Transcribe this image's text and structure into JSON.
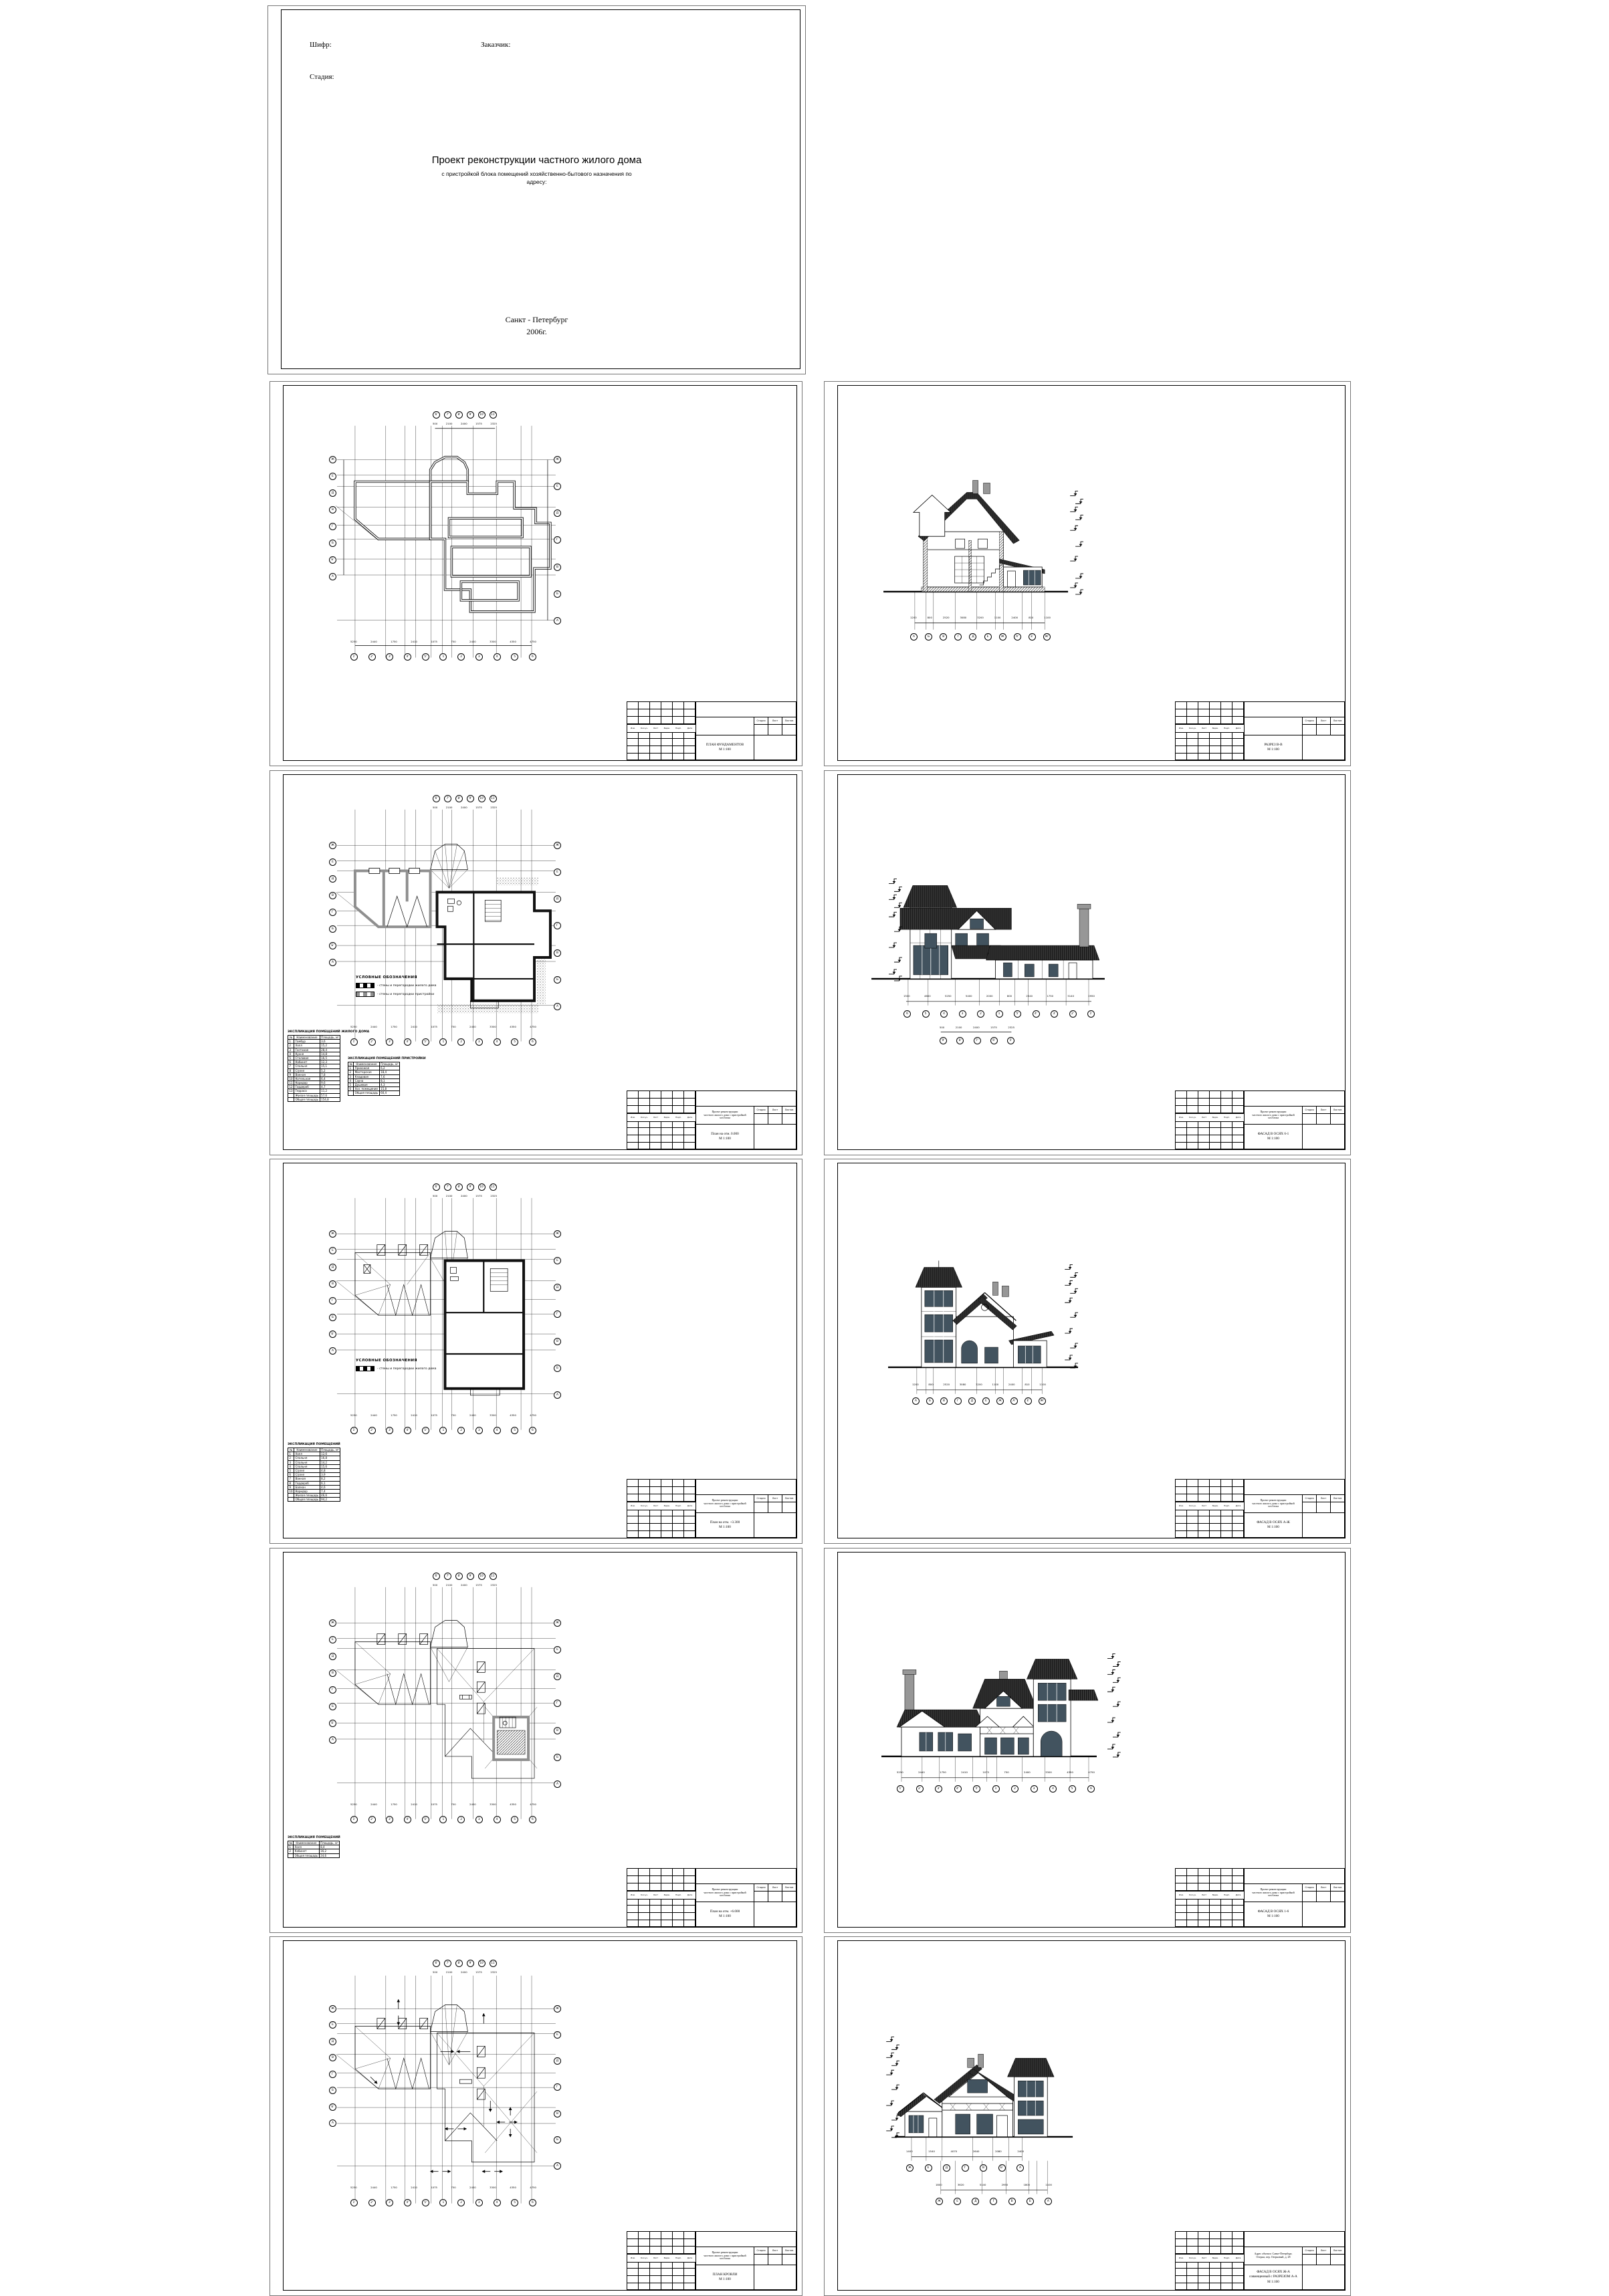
{
  "colors": {
    "ink": "#000000",
    "roof_dark": "#1c1c1c",
    "window_glass": "#42535f",
    "addition_wall_gray": "#8f8f8f",
    "chimney_gray": "#979797",
    "paper": "#ffffff"
  },
  "title_page": {
    "code_label": "Шифр:",
    "client_label": "Заказчик:",
    "stage_label": "Стадия:",
    "title": "Проект реконструкции частного жилого дома",
    "subtitle_line1": "с пристройкой блока помещений хозяйственно-бытового назначения по",
    "subtitle_line2": "адресу:",
    "city": "Санкт - Петербург",
    "year": "2006г."
  },
  "stamp_common": {
    "revision_headers": [
      "Изм.",
      "Кол.уч.",
      "Лист",
      "№док.",
      "Подп.",
      "Дата"
    ],
    "status_headers": [
      "Стадия",
      "Лист",
      "Листов"
    ]
  },
  "tables": {
    "cols": [
      "№",
      "Наименование",
      "Площадь, м²"
    ],
    "home": {
      "title": "ЭКСПЛИКАЦИЯ ПОМЕЩЕНИЙ ЖИЛОГО ДОМА",
      "rows": [
        [
          "1",
          "Тамбур",
          "3,6"
        ],
        [
          "2",
          "Холл",
          "15,2"
        ],
        [
          "3",
          "Гостиная",
          "28,4"
        ],
        [
          "4",
          "Кухня",
          "14,8"
        ],
        [
          "5",
          "Столовая",
          "16,5"
        ],
        [
          "6",
          "Кабинет",
          "12,3"
        ],
        [
          "7",
          "Спальня",
          "15,1"
        ],
        [
          "8",
          "С/узел",
          "5,2"
        ],
        [
          "9",
          "Ванная",
          "7,8"
        ],
        [
          "10",
          "Котельная",
          "6,4"
        ],
        [
          "11",
          "Коридор",
          "9,6"
        ],
        [
          "12",
          "Гардероб",
          "4,7"
        ],
        [
          "13",
          "Терраса",
          "11,2"
        ],
        [
          "",
          "Жилая площадь",
          "57,6"
        ],
        [
          "",
          "Общая площадь",
          "154,8"
        ]
      ]
    },
    "addition": {
      "title": "ЭКСПЛИКАЦИЯ ПОМЕЩЕНИЙ ПРИСТРОЙКИ",
      "rows": [
        [
          "1",
          "Прихожая",
          "6,2"
        ],
        [
          "2",
          "Мастерская",
          "18,4"
        ],
        [
          "3",
          "Кладовая",
          "7,6"
        ],
        [
          "4",
          "Сауна",
          "8,1"
        ],
        [
          "5",
          "Душевая",
          "4,3"
        ],
        [
          "6",
          "Хоз. помещение",
          "15,8"
        ],
        [
          "",
          "Общая площадь",
          "60,4"
        ]
      ]
    },
    "floor2": {
      "title": "ЭКСПЛИКАЦИЯ ПОМЕЩЕНИЙ",
      "rows": [
        [
          "1",
          "Холл",
          "12,6"
        ],
        [
          "2",
          "Спальня",
          "16,8"
        ],
        [
          "3",
          "Спальня",
          "14,2"
        ],
        [
          "4",
          "Спальня",
          "15,6"
        ],
        [
          "5",
          "С/узел",
          "4,8"
        ],
        [
          "6",
          "С/узел",
          "3,9"
        ],
        [
          "7",
          "Ванная",
          "8,2"
        ],
        [
          "8",
          "Гардероб",
          "6,1"
        ],
        [
          "9",
          "Балкон",
          "4,6"
        ],
        [
          "10",
          "Коридор",
          "7,4"
        ],
        [
          "",
          "Жилая площадь",
          "46,6"
        ],
        [
          "",
          "Общая площадь",
          "94,2"
        ]
      ]
    },
    "floor3": {
      "title": "ЭКСПЛИКАЦИЯ ПОМЕЩЕНИЙ",
      "rows": [
        [
          "1",
          "Холл",
          "8,4"
        ],
        [
          "2",
          "Кабинет",
          "16,2"
        ],
        [
          "",
          "Общая площадь",
          "24,6"
        ]
      ]
    }
  },
  "legend_title": "УСЛОВНЫЕ ОБОЗНАЧЕНИЯ",
  "legend_home": "- стены и перегородки жилого дома",
  "legend_addition": "- стены и перегородки пристройки",
  "sheets": [
    {
      "id": "title-page"
    },
    {
      "id": "foundation-plan",
      "stamp": {
        "project_lines": [],
        "title_lines": [
          "ПЛАН ФУНДАМЕНТОВ",
          "М 1:100"
        ]
      },
      "axes_top": [
        "6'",
        "7'",
        "8'",
        "9'",
        "10'",
        "11'"
      ],
      "axes_bottom": [
        "1'",
        "2'",
        "3'",
        "4'",
        "5'",
        "1",
        "2",
        "3",
        "4",
        "5",
        "6"
      ],
      "axes_left": [
        "Ж",
        "Е",
        "Д",
        "В",
        "Г",
        "Б",
        "Б'",
        "А"
      ],
      "axes_right": [
        "Ж",
        "Е",
        "Д",
        "Г",
        "В",
        "Б",
        "А"
      ],
      "dims_top": [
        "500",
        "2100",
        "2400",
        "1575",
        "2325"
      ],
      "dims_bottom": [
        "5250",
        "2440",
        "1750",
        "2410",
        "1075",
        "750",
        "2400",
        "3300",
        "4350",
        "4750"
      ]
    },
    {
      "id": "section-v-v",
      "stamp": {
        "project_lines": [],
        "title_lines": [
          "РАЗРЕЗ В-В",
          "М 1:100"
        ]
      },
      "axes_bottom": [
        "А",
        "Б",
        "В",
        "Г",
        "Д",
        "Е",
        "Ж",
        "А'",
        "Е'",
        "Ж'"
      ],
      "dims_bottom": [
        "1200",
        "800",
        "2520",
        "3080",
        "3200",
        "1100",
        "2400",
        "810",
        "1100"
      ]
    },
    {
      "id": "plan-0-000",
      "stamp": {
        "project_lines": [
          "Проект реконструкции",
          "частного жилого дома с пристройкой",
          "хоз.блока"
        ],
        "title_lines": [
          "План на отм. 0.000",
          "М 1:100"
        ]
      },
      "axes_top": [
        "6'",
        "7'",
        "8'",
        "9'",
        "10'",
        "11'"
      ],
      "axes_bottom": [
        "1'",
        "2'",
        "3'",
        "4'",
        "5'",
        "1",
        "2",
        "3",
        "4",
        "5",
        "6"
      ],
      "axes_left": [
        "Ж",
        "Е",
        "Д",
        "В",
        "Г",
        "Б",
        "Б'",
        "А"
      ],
      "axes_right": [
        "Ж",
        "Е",
        "Д",
        "Г",
        "В",
        "Б",
        "А"
      ],
      "dims_top": [
        "500",
        "2100",
        "2400",
        "1575",
        "2325"
      ],
      "dims_bottom": [
        "5250",
        "2440",
        "1750",
        "2410",
        "1075",
        "750",
        "2400",
        "3300",
        "4350",
        "4750"
      ]
    },
    {
      "id": "facade-6-1",
      "stamp": {
        "project_lines": [
          "Проект реконструкции",
          "частного жилого дома с пристройкой",
          "хоз.блока"
        ],
        "title_lines": [
          "ФАСАД В ОСЯХ 6-1",
          "М 1:100"
        ]
      },
      "axes_bottom": [
        "6",
        "5",
        "4",
        "3",
        "2",
        "1",
        "5'",
        "4'",
        "3'",
        "2'",
        "1'"
      ],
      "axes_bottom2": [
        "9'",
        "8'",
        "7'",
        "6'",
        "5'"
      ],
      "dims_bottom": [
        "1500",
        "4600",
        "5250",
        "5400",
        "2000",
        "800",
        "2540",
        "1750",
        "5140",
        "2950"
      ],
      "dims_bottom2": [
        "500",
        "2100",
        "2400",
        "1575",
        "2325"
      ]
    },
    {
      "id": "plan-3-300",
      "stamp": {
        "project_lines": [
          "Проект реконструкции",
          "частного жилого дома с пристройкой",
          "хоз.блока"
        ],
        "title_lines": [
          "План на отм. +3.300",
          "М 1:100"
        ]
      },
      "axes_top": [
        "6'",
        "7'",
        "8'",
        "9'",
        "10'",
        "11'"
      ],
      "axes_bottom": [
        "1'",
        "2'",
        "3'",
        "4'",
        "5'",
        "1",
        "2",
        "3",
        "4",
        "5",
        "6"
      ],
      "axes_left": [
        "Ж",
        "Е",
        "Д",
        "В",
        "Г",
        "Б",
        "Б'",
        "А"
      ],
      "axes_right": [
        "Ж",
        "Е",
        "Д",
        "Г",
        "В",
        "Б",
        "А"
      ],
      "dims_top": [
        "500",
        "2100",
        "2400",
        "1575",
        "2325"
      ],
      "dims_bottom": [
        "5250",
        "2440",
        "1750",
        "2410",
        "1075",
        "750",
        "2400",
        "3300",
        "4350",
        "4750"
      ]
    },
    {
      "id": "facade-a-zh",
      "stamp": {
        "project_lines": [
          "Проект реконструкции",
          "частного жилого дома с пристройкой",
          "хоз.блока"
        ],
        "title_lines": [
          "ФАСАД В ОСЯХ А-Ж",
          "М 1:100"
        ]
      },
      "axes_bottom": [
        "А",
        "Б",
        "В",
        "Г",
        "Д",
        "Е",
        "Ж",
        "А'",
        "Е'",
        "Ж'"
      ],
      "dims_bottom": [
        "1200",
        "800",
        "2520",
        "3080",
        "3200",
        "1100",
        "2400",
        "810",
        "1100"
      ]
    },
    {
      "id": "plan-6-000",
      "stamp": {
        "project_lines": [
          "Проект реконструкции",
          "частного жилого дома с пристройкой",
          "хоз.блока"
        ],
        "title_lines": [
          "План на отм. +6.000",
          "М 1:100"
        ]
      },
      "axes_top": [
        "6'",
        "7'",
        "8'",
        "9'",
        "10'",
        "11'"
      ],
      "axes_bottom": [
        "1'",
        "2'",
        "3'",
        "4'",
        "5'",
        "1",
        "2",
        "3",
        "4",
        "5",
        "6"
      ],
      "axes_left": [
        "Ж",
        "Е",
        "Д",
        "В",
        "Г",
        "Б",
        "Б'",
        "А"
      ],
      "axes_right": [
        "Ж",
        "Е",
        "Д",
        "Г",
        "В",
        "Б",
        "А"
      ],
      "dims_top": [
        "500",
        "2100",
        "2400",
        "1575",
        "2325"
      ],
      "dims_bottom": [
        "5250",
        "2440",
        "1750",
        "2410",
        "1075",
        "750",
        "2400",
        "3300",
        "4350",
        "4750"
      ]
    },
    {
      "id": "facade-1-6",
      "stamp": {
        "project_lines": [
          "Проект реконструкции",
          "частного жилого дома с пристройкой",
          "хоз.блока"
        ],
        "title_lines": [
          "ФАСАД В ОСЯХ 1-6",
          "М 1:100"
        ]
      },
      "axes_bottom": [
        "1'",
        "2'",
        "3'",
        "4'",
        "5'",
        "1",
        "2",
        "3",
        "4",
        "5",
        "6"
      ],
      "dims_bottom": [
        "5250",
        "2440",
        "1750",
        "2410",
        "1075",
        "750",
        "2400",
        "3300",
        "4350",
        "4750"
      ]
    },
    {
      "id": "roof-plan",
      "stamp": {
        "project_lines": [
          "Проект реконструкции",
          "частного жилого дома с пристройкой",
          "хоз.блока"
        ],
        "title_lines": [
          "ПЛАН КРОВЛИ",
          "М 1:100"
        ]
      },
      "axes_top": [
        "6'",
        "7'",
        "8'",
        "9'",
        "10'",
        "11'"
      ],
      "axes_bottom": [
        "1'",
        "2'",
        "3'",
        "4'",
        "5'",
        "1",
        "2",
        "3",
        "4",
        "5",
        "6"
      ],
      "axes_left": [
        "Ж",
        "Е",
        "Д",
        "В",
        "Г",
        "Б",
        "Б'",
        "А"
      ],
      "axes_right": [
        "Ж",
        "Е",
        "Д",
        "Г",
        "В",
        "Б",
        "А"
      ],
      "dims_top": [
        "500",
        "2100",
        "2400",
        "1575",
        "2325"
      ],
      "dims_bottom": [
        "5250",
        "2440",
        "1750",
        "2410",
        "1075",
        "750",
        "2400",
        "3300",
        "4350",
        "4750"
      ]
    },
    {
      "id": "facade-zh-a-razrez-a-a",
      "stamp": {
        "project_lines": [
          "Адрес объекта: Санкт-Петербург,",
          "Озерки, пер. Озерковый, д. 28"
        ],
        "title_lines": [
          "ФАСАД В ОСЯХ Ж-А",
          "совмещенный с РАЗРЕЗОМ А-А",
          "М 1:100"
        ]
      },
      "axes_bottom": [
        "Ж",
        "Е",
        "Д",
        "Г",
        "В",
        "Б'",
        "А"
      ],
      "axes_bottom2": [
        "Ж",
        "Е",
        "Д",
        "Г",
        "В",
        "Б",
        "А"
      ],
      "dims_bottom": [
        "1400",
        "1540",
        "4070",
        "2640",
        "2080",
        "2400"
      ],
      "dims_bottom2": [
        "1800",
        "3620",
        "5140",
        "2950",
        "1800",
        "1100"
      ]
    }
  ]
}
